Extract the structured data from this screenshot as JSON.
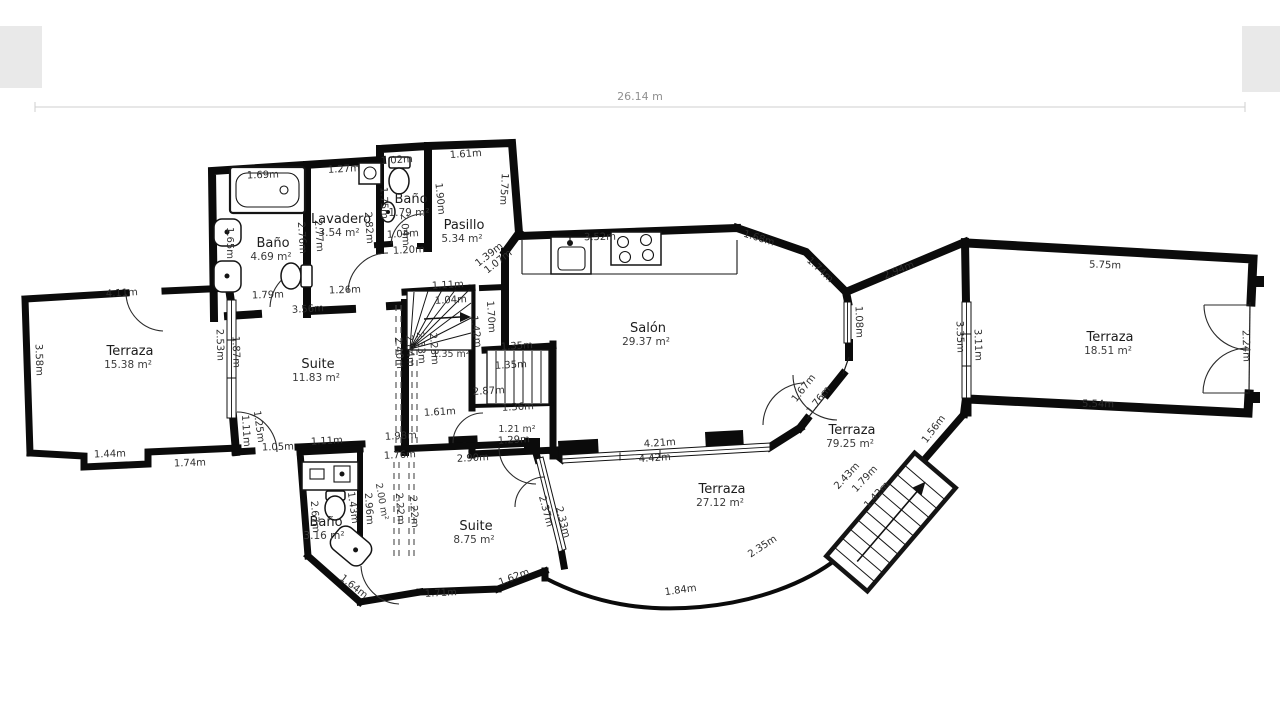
{
  "meta": {
    "total_width": "26.14 m"
  },
  "rooms": [
    {
      "name": "Baño",
      "area": "4.69 m²",
      "x": 273,
      "y": 247
    },
    {
      "name": "Lavadero",
      "area": "3.54 m²",
      "x": 341,
      "y": 223
    },
    {
      "name": "Baño",
      "area": "1.79 m²",
      "x": 411,
      "y": 203
    },
    {
      "name": "Pasillo",
      "area": "5.34 m²",
      "x": 464,
      "y": 229
    },
    {
      "name": "Terraza",
      "area": "15.38 m²",
      "x": 130,
      "y": 355
    },
    {
      "name": "Suite",
      "area": "11.83 m²",
      "x": 318,
      "y": 368
    },
    {
      "name": "Salón",
      "area": "29.37 m²",
      "x": 648,
      "y": 332
    },
    {
      "name": "Terraza",
      "area": "79.25 m²",
      "x": 852,
      "y": 434
    },
    {
      "name": "Terraza",
      "area": "18.51 m²",
      "x": 1110,
      "y": 341
    },
    {
      "name": "Baño",
      "area": "3.16 m²",
      "x": 326,
      "y": 526
    },
    {
      "name": "Suite",
      "area": "8.75 m²",
      "x": 476,
      "y": 530
    },
    {
      "name": "Terraza",
      "area": "27.12 m²",
      "x": 722,
      "y": 493
    },
    {
      "name": "",
      "area": "1.35 m²",
      "x": 451,
      "y": 357,
      "small": true
    },
    {
      "name": "",
      "area": "1.21 m²",
      "x": 517,
      "y": 432,
      "small": true
    },
    {
      "name": "",
      "area": "2.00 m²",
      "x": 379,
      "y": 502,
      "small": true,
      "r": 80
    }
  ],
  "dimension_labels": [
    {
      "t": "1.69m",
      "x": 263,
      "y": 178,
      "r": -2
    },
    {
      "t": "1.27m",
      "x": 344,
      "y": 172,
      "r": -3
    },
    {
      "t": "1.02m",
      "x": 397,
      "y": 163,
      "r": -4
    },
    {
      "t": "1.61m",
      "x": 466,
      "y": 157,
      "r": -4
    },
    {
      "t": "1.65m",
      "x": 227,
      "y": 243,
      "r": 90
    },
    {
      "t": "2.76m",
      "x": 299,
      "y": 238,
      "r": 86
    },
    {
      "t": "2.77m",
      "x": 316,
      "y": 236,
      "r": 86
    },
    {
      "t": "2.82m",
      "x": 366,
      "y": 228,
      "r": 86
    },
    {
      "t": "2.04m",
      "x": 402,
      "y": 230,
      "r": 86
    },
    {
      "t": "1.75m",
      "x": 381,
      "y": 203,
      "r": 88
    },
    {
      "t": "1.90m",
      "x": 437,
      "y": 199,
      "r": 84
    },
    {
      "t": "1.75m",
      "x": 501,
      "y": 189,
      "r": 93
    },
    {
      "t": "1.79m",
      "x": 268,
      "y": 298,
      "r": -2
    },
    {
      "t": "1.26m",
      "x": 345,
      "y": 293,
      "r": -2
    },
    {
      "t": "3.56m",
      "x": 308,
      "y": 312,
      "r": -3
    },
    {
      "t": "1.04m",
      "x": 403,
      "y": 237,
      "r": -3
    },
    {
      "t": "1.20m",
      "x": 409,
      "y": 253,
      "r": -3
    },
    {
      "t": "1.39m",
      "x": 491,
      "y": 257,
      "r": -38
    },
    {
      "t": "1.07m",
      "x": 500,
      "y": 264,
      "r": -38
    },
    {
      "t": "1.11m",
      "x": 448,
      "y": 288,
      "r": -3
    },
    {
      "t": "1.04m",
      "x": 451,
      "y": 303,
      "r": -3
    },
    {
      "t": "1.70m",
      "x": 488,
      "y": 317,
      "r": 86
    },
    {
      "t": "1.42m",
      "x": 473,
      "y": 332,
      "r": 82
    },
    {
      "t": "2.40m",
      "x": 396,
      "y": 353,
      "r": 86
    },
    {
      "t": "2.84m",
      "x": 407,
      "y": 351,
      "r": 86
    },
    {
      "t": "2.53m",
      "x": 418,
      "y": 348,
      "r": 86
    },
    {
      "t": "2.23m",
      "x": 431,
      "y": 349,
      "r": 86
    },
    {
      "t": "1.35m",
      "x": 517,
      "y": 349,
      "r": -3
    },
    {
      "t": "1.35m",
      "x": 511,
      "y": 368,
      "r": -3
    },
    {
      "t": "2.87m",
      "x": 489,
      "y": 394,
      "r": -3
    },
    {
      "t": "1.36m",
      "x": 518,
      "y": 410,
      "r": -3
    },
    {
      "t": "1.61m",
      "x": 440,
      "y": 415,
      "r": -3
    },
    {
      "t": "1.29m",
      "x": 514,
      "y": 443,
      "r": -3
    },
    {
      "t": "1.98m",
      "x": 401,
      "y": 439,
      "r": -3
    },
    {
      "t": "4.11m",
      "x": 122,
      "y": 296,
      "r": -3
    },
    {
      "t": "3.58m",
      "x": 36,
      "y": 360,
      "r": 88
    },
    {
      "t": "2.53m",
      "x": 217,
      "y": 345,
      "r": 88
    },
    {
      "t": "1.87m",
      "x": 233,
      "y": 352,
      "r": 88
    },
    {
      "t": "1.44m",
      "x": 110,
      "y": 457,
      "r": -2
    },
    {
      "t": "1.74m",
      "x": 190,
      "y": 466,
      "r": -2
    },
    {
      "t": "1.11m",
      "x": 243,
      "y": 431,
      "r": 86
    },
    {
      "t": "1.25m",
      "x": 256,
      "y": 427,
      "r": 82
    },
    {
      "t": "1.05m",
      "x": 278,
      "y": 450,
      "r": -2
    },
    {
      "t": "1.11m",
      "x": 327,
      "y": 444,
      "r": -3
    },
    {
      "t": "3.52m",
      "x": 600,
      "y": 240,
      "r": -1
    },
    {
      "t": "1.68m",
      "x": 758,
      "y": 241,
      "r": 17
    },
    {
      "t": "1.74m",
      "x": 818,
      "y": 272,
      "r": 43
    },
    {
      "t": "1.08m",
      "x": 856,
      "y": 322,
      "r": 88
    },
    {
      "t": "1.67m",
      "x": 806,
      "y": 390,
      "r": -52
    },
    {
      "t": "1.76m",
      "x": 821,
      "y": 402,
      "r": -52
    },
    {
      "t": "4.21m",
      "x": 660,
      "y": 446,
      "r": -4
    },
    {
      "t": "4.42m",
      "x": 655,
      "y": 461,
      "r": -4
    },
    {
      "t": "2.94m",
      "x": 900,
      "y": 273,
      "r": -22
    },
    {
      "t": "1.56m",
      "x": 936,
      "y": 431,
      "r": -53
    },
    {
      "t": "2.43m",
      "x": 849,
      "y": 478,
      "r": -47
    },
    {
      "t": "1.79m",
      "x": 867,
      "y": 481,
      "r": -47
    },
    {
      "t": "1.42m",
      "x": 879,
      "y": 497,
      "r": -47
    },
    {
      "t": "2.35m",
      "x": 764,
      "y": 549,
      "r": -33
    },
    {
      "t": "1.84m",
      "x": 681,
      "y": 593,
      "r": -8
    },
    {
      "t": "3.35m",
      "x": 957,
      "y": 337,
      "r": 88
    },
    {
      "t": "3.11m",
      "x": 975,
      "y": 345,
      "r": 88
    },
    {
      "t": "5.75m",
      "x": 1105,
      "y": 268,
      "r": 2
    },
    {
      "t": "5.54m",
      "x": 1098,
      "y": 407,
      "r": 1
    },
    {
      "t": "2.24m",
      "x": 1243,
      "y": 346,
      "r": 88
    },
    {
      "t": "1.76m",
      "x": 400,
      "y": 458,
      "r": -3
    },
    {
      "t": "2.90m",
      "x": 473,
      "y": 461,
      "r": -3
    },
    {
      "t": "2.67m",
      "x": 312,
      "y": 517,
      "r": 86
    },
    {
      "t": "1.43m",
      "x": 350,
      "y": 508,
      "r": 82
    },
    {
      "t": "2.96m",
      "x": 366,
      "y": 509,
      "r": 86
    },
    {
      "t": "2.22m",
      "x": 397,
      "y": 509,
      "r": 86
    },
    {
      "t": "2.22m",
      "x": 411,
      "y": 512,
      "r": 86
    },
    {
      "t": "2.37m",
      "x": 543,
      "y": 512,
      "r": 75
    },
    {
      "t": "2.33m",
      "x": 560,
      "y": 523,
      "r": 75
    },
    {
      "t": "1.64m",
      "x": 352,
      "y": 589,
      "r": 38
    },
    {
      "t": "1.71m",
      "x": 441,
      "y": 596,
      "r": -3
    },
    {
      "t": "1.62m",
      "x": 515,
      "y": 580,
      "r": -21
    }
  ]
}
